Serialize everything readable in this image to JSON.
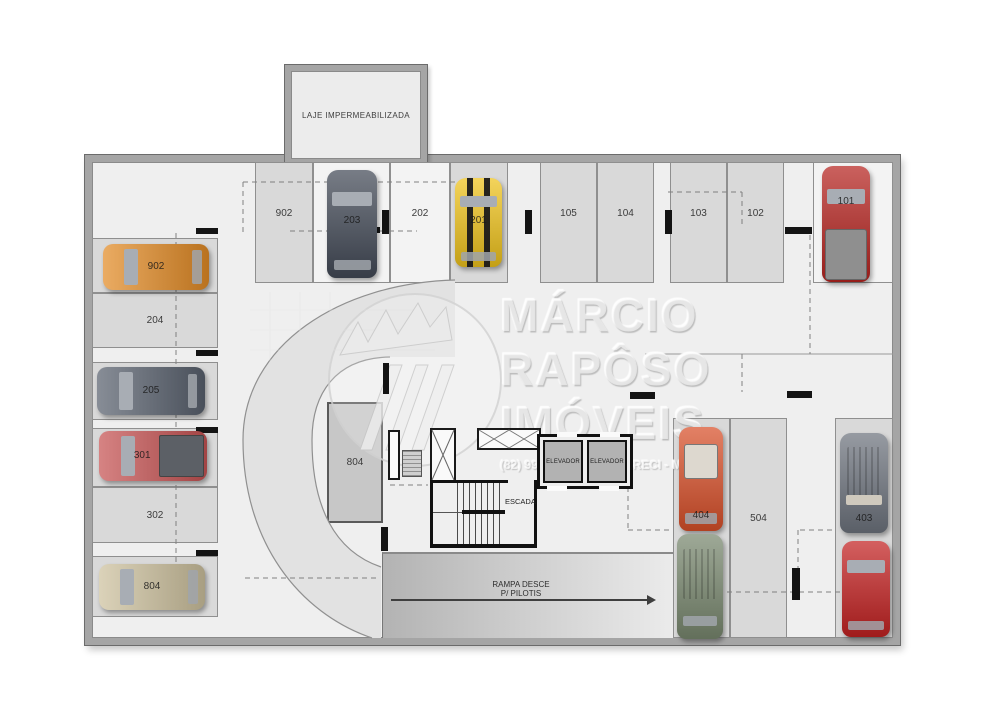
{
  "plan": {
    "laje_label": "LAJE IMPERMEABILIZADA",
    "elevator_label": "ELEVADOR",
    "stairs_label": "ESCADA",
    "ramp_label_line1": "RAMPA DESCE",
    "ramp_label_line2": "P/ PILOTIS"
  },
  "spaces": {
    "t902": "902",
    "t202": "202",
    "t105": "105",
    "t104": "104",
    "t103": "103",
    "t102": "102",
    "l204": "204",
    "l302": "302",
    "c804": "804",
    "r504": "504"
  },
  "cars": {
    "c203": {
      "label": "203",
      "color": "#434a57"
    },
    "c201": {
      "label": "201",
      "color": "#efc31c"
    },
    "c101": {
      "label": "101",
      "color": "#b62420"
    },
    "c902": {
      "label": "902",
      "color": "#e28b26"
    },
    "c205": {
      "label": "205",
      "color": "#59616e"
    },
    "c301": {
      "label": "301",
      "color": "#c65353"
    },
    "c804": {
      "label": "804",
      "color": "#cdc19e"
    },
    "c404": {
      "label": "404",
      "color": "#d8502a"
    },
    "c403": {
      "label": "403",
      "color": "#6e747e"
    },
    "green_suv": {
      "label": "",
      "color": "#79886f"
    },
    "red_coupe": {
      "label": "",
      "color": "#c32222"
    }
  },
  "watermark": {
    "lines": [
      "MÁRCIO",
      "RAPÔSO",
      "IMÓVEIS"
    ],
    "phone": "(82) 9999-9999",
    "creci": "CRECI - MAL"
  },
  "palette": {
    "wall": "#a5a5a5",
    "floor": "#efefef",
    "stall_shaded": "#d9d9d9",
    "drive_band": "#e2e2e2",
    "core_wall": "#111111",
    "ramp_dark": "#b3b3b3",
    "ramp_light": "#ebebeb"
  }
}
